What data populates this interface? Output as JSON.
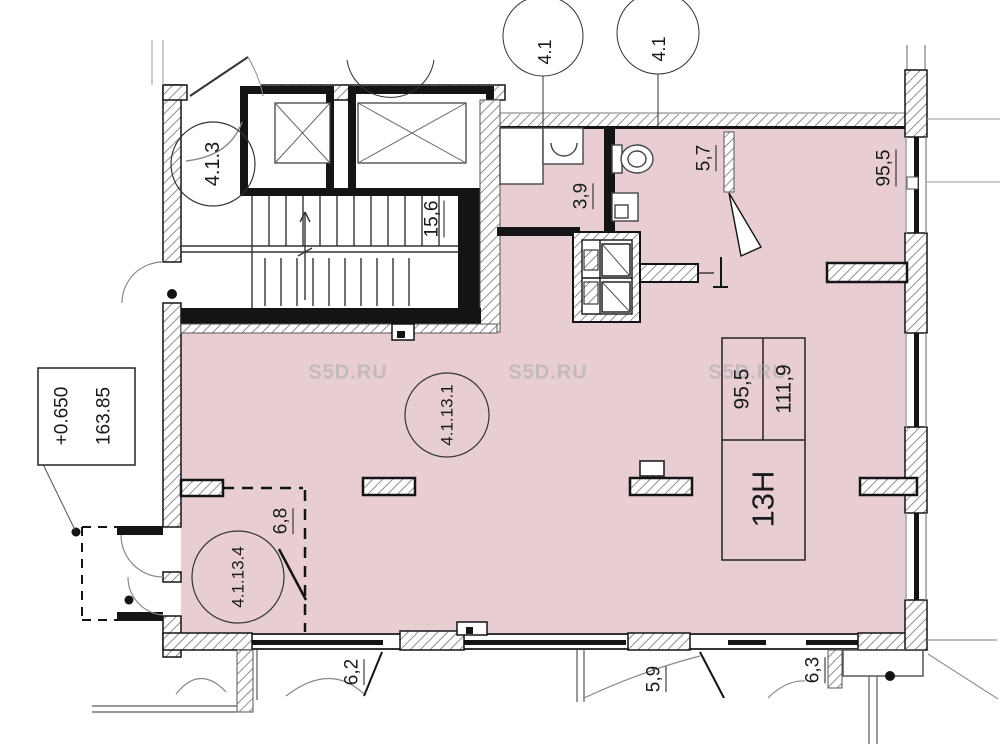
{
  "colors": {
    "room_fill": "#e8ced3",
    "wall": "#141414",
    "hatch_line": "#8f8f8f",
    "watermark": "#a8a8a8"
  },
  "watermark": {
    "text": "S5D.RU"
  },
  "axis_bubbles": [
    {
      "label": "4.1"
    },
    {
      "label": "4.1"
    }
  ],
  "labels": {
    "lobby_id": "4.1.3",
    "stairwell_area": "15,6",
    "bathroom_area": "3,9",
    "wc_area": "5,7",
    "main_room_dim": "95,5",
    "main_room_id": "4.1.13.1",
    "corner_room_id": "4.1.13.4",
    "corner_room_area": "6,8",
    "balcony_left_area": "6,2",
    "balcony_mid_area": "5,9",
    "balcony_right_area": "6,3"
  },
  "elevation_box": {
    "level": "+0.650",
    "mark": "163.85"
  },
  "unit_table": {
    "col1": "95,5",
    "col2": "111,9",
    "unit": "13Н"
  }
}
